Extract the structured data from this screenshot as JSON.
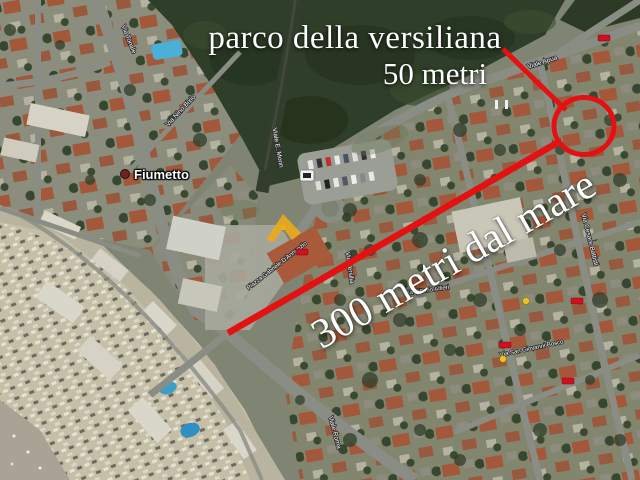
{
  "annotations": {
    "park_label": "parco della versiliana",
    "park_distance_label": "50 metri",
    "sea_distance_label": "300 metri dal mare"
  },
  "map": {
    "locality_label": "Fiumetto",
    "street_labels": [
      "Via Tonale",
      "Via Nino Bixio",
      "Viale E. Morin",
      "Viale Apua",
      "Piazza Gabriele D'Annunzio",
      "Via Versilia",
      "Via Vittorio Alfieri",
      "Viale Roma",
      "Via Cesare Battisti",
      "Via San Giovanni Bosco"
    ]
  },
  "colors": {
    "annotation_red": "#e31111",
    "annotation_text": "#ffffff",
    "watermark_yellow": "#e9a91d",
    "park_green": "#2f3e28",
    "sand": "#c6bfa8",
    "road_gray": "#8a8d84",
    "pool_blue": "#3aa0c8"
  }
}
